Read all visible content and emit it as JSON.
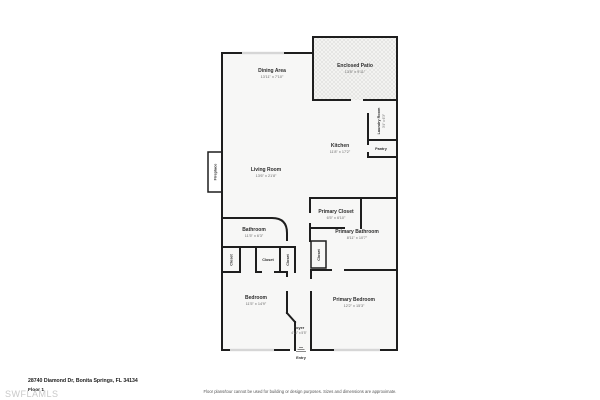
{
  "floorplan": {
    "rooms": {
      "dining": {
        "name": "Dining Area",
        "dims": "13'11\" x 7'10\""
      },
      "patio": {
        "name": "Enclosed Patio",
        "dims": "13'8\" x 9'11\""
      },
      "laundry": {
        "name": "Laundry Room",
        "dims": "3'4\" x 6'3\""
      },
      "pantry": {
        "name": "Pantry"
      },
      "kitchen": {
        "name": "Kitchen",
        "dims": "11'8\" x 17'2\""
      },
      "living": {
        "name": "Living Room",
        "dims": "13'6\" x 21'8\""
      },
      "fireplace": {
        "name": "Fireplace"
      },
      "primary_closet": {
        "name": "Primary Closet",
        "dims": "6'5\" x 6'10\""
      },
      "primary_bath": {
        "name": "Primary Bathroom",
        "dims": "8'11\" x 10'7\""
      },
      "bathroom": {
        "name": "Bathroom",
        "dims": "11'5\" x 6'3\""
      },
      "closet_hall": {
        "name": "Closet"
      },
      "closet_left": {
        "name": "Closet"
      },
      "closet_center": {
        "name": "Closet"
      },
      "closet_right": {
        "name": "Closet"
      },
      "bedroom": {
        "name": "Bedroom",
        "dims": "11'5\" x 14'9\""
      },
      "primary_bedroom": {
        "name": "Primary Bedroom",
        "dims": "12'2\" x 15'3\""
      },
      "foyer": {
        "name": "Foyer",
        "dims": "4'11\" x 5'5\""
      },
      "entry": {
        "name": "Entry"
      }
    },
    "footer": {
      "address": "28740 Diamond Dr, Bonita Springs, FL 34134",
      "floor_label": "Floor 1",
      "watermark": "SWFLAMLS",
      "disclaimer": "Floor plans/tour cannot be used for building or design purposes. Sizes and dimensions are approximate."
    },
    "colors": {
      "wall": "#1e1e1e",
      "floor": "#f7f7f6",
      "window": "#d6d6d6",
      "patio_hatch": "#d9d9d6"
    }
  }
}
